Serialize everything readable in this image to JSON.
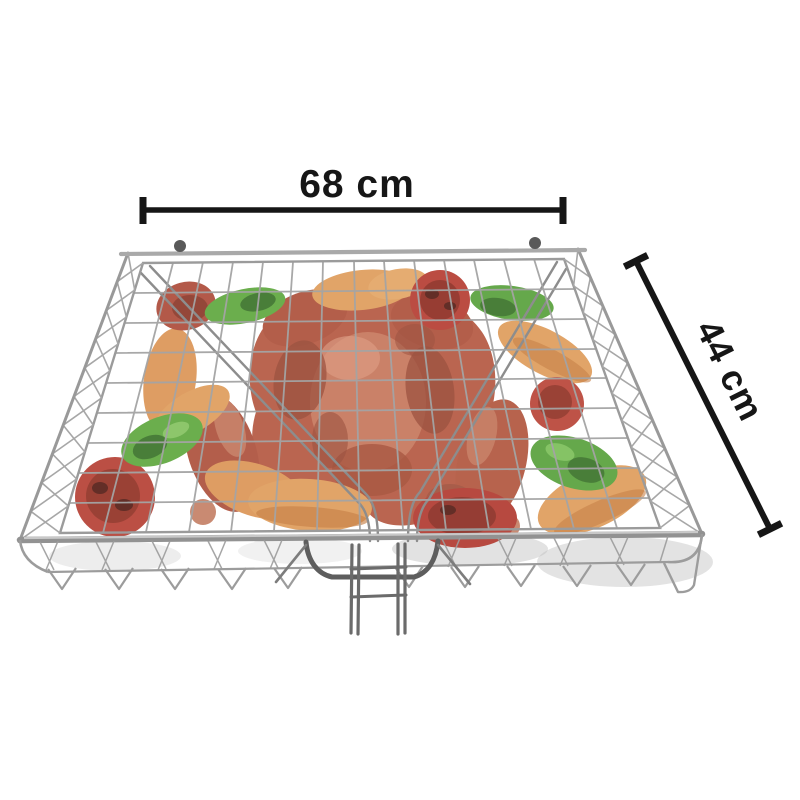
{
  "page": {
    "type": "product-photo",
    "background_color": "#ffffff"
  },
  "product": {
    "item": "chrome wire BBQ grill basket with long handle",
    "contents": [
      "grilled chicken",
      "pumpkin slices",
      "green peppers",
      "tomatoes"
    ]
  },
  "annotations": {
    "width_label": "68 cm",
    "depth_label": "44 cm",
    "line_color": "#161616"
  },
  "colors": {
    "wire": "#8f8f8f",
    "wire_dark": "#4f4f4f",
    "chicken": "#b3523a",
    "chicken_dark": "#93402b",
    "chicken_light": "#cf8061",
    "tomato": "#b2372a",
    "tomato_dark": "#6f1c10",
    "pepper": "#55a233",
    "pepper_dark": "#2f6b1c",
    "pumpkin": "#db9450",
    "pumpkin_dark": "#bc6e2f",
    "shadow": "#c2c2c2"
  }
}
